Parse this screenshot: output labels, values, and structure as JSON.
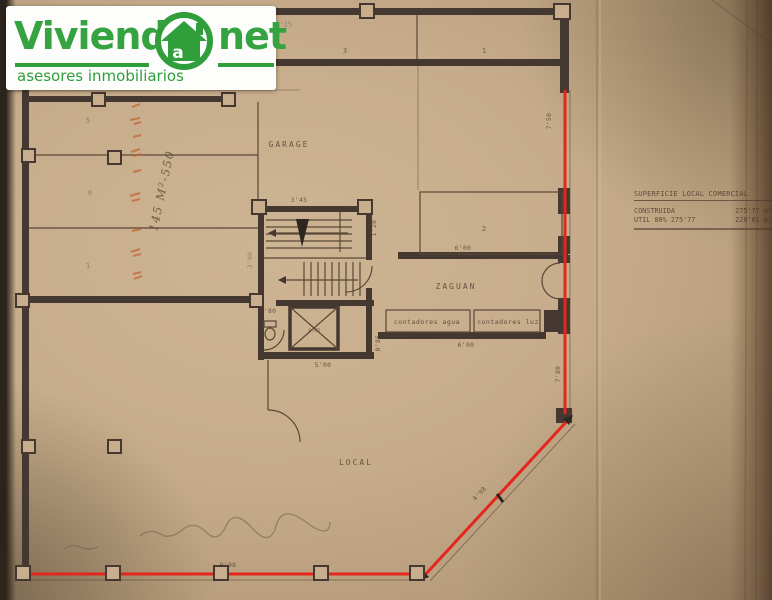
{
  "logo": {
    "brand_left": "Viviend",
    "brand_right": "net",
    "at_letter": "a",
    "subtitle": "asesores inmobiliarios",
    "green": "#2f9e3b"
  },
  "summary_table": {
    "title": "SUPERFICIE LOCAL COMERCIAL",
    "rows": [
      {
        "label": "CONSTRUIDA",
        "value": "275'77 m²"
      },
      {
        "label": "UTIL 80% 275'77",
        "value": "220'61 m²"
      }
    ]
  },
  "plan": {
    "rooms": {
      "garage": "GARAGE",
      "zaguan": "ZAGUAN",
      "local": "LOCAL",
      "contadores_agua": "contadores agua",
      "contadores_luz": "contadores luz"
    },
    "room_numbers": {
      "top_a": "3",
      "top_b": "1",
      "right": "2",
      "left_a": "5",
      "left_b": "6",
      "left_c": "1",
      "elevator": "4.00"
    },
    "dimensions": {
      "top_left": "17'25",
      "stair_top": "3'45",
      "stair_right": "1'20",
      "stair_left": "3'00",
      "right_upper": "7'50",
      "right_lower": "7'80",
      "zaguan_width": "6'00",
      "meters_width": "6'00",
      "meters_depth": "0'85",
      "corridor": "5'00",
      "wc": "0'80",
      "left_lower": "10'80",
      "bottom": "9'98",
      "chamfer": "4'98"
    },
    "handwriting": {
      "area_note": "145 M²-550"
    }
  },
  "colors": {
    "logo_green": "#2f9e3b",
    "facade_red": "#e3271e",
    "ink": "#453831",
    "paper": "#c3a987"
  }
}
